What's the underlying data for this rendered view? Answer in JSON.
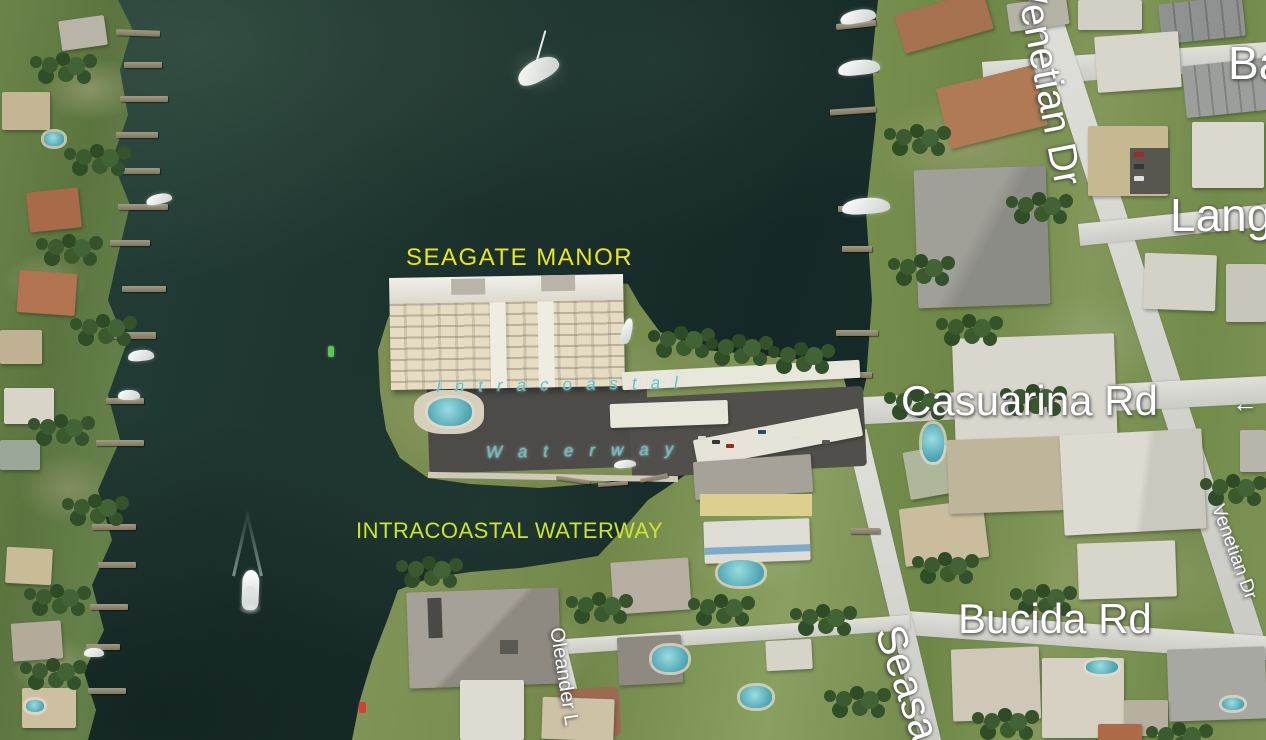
{
  "map": {
    "annotations": {
      "seagate_manor": "SEAGATE MANOR",
      "intracoastal_waterway": "INTRACOASTAL WATERWAY"
    },
    "water_text": {
      "line1": "Intracoastal",
      "line2": "Waterway"
    },
    "road_labels": {
      "venetian_top": "Venetian Dr",
      "ba_partial": "Ba",
      "lang_partial": "Lang",
      "casuarina": "Casuarina Rd",
      "direction_arrow": "←",
      "bucida": "Bucida Rd",
      "seasage_partial": "Seasa",
      "oleander_partial": "Oleander L",
      "venetian_small": "Venetian Dr"
    },
    "icons": {
      "catamaran_icon": "white anchored catamaran with mast",
      "motorboat_icon": "white motorboat cruising south with V wake",
      "channel_marker_green_icon": "green channel-marker pile",
      "buoy_red_icon": "red buoy",
      "sailboat_icon": "small white moored sailboat"
    },
    "colors": {
      "annotation_yellow": "#eae618",
      "annotation_yellow_green": "#cde32c",
      "road_label_white": "#ffffff",
      "water_text_teal": "#66bfca",
      "water_dark": "#16282a",
      "land_green": "#74894c",
      "road_surface": "#d7d7d1",
      "channel_marker_green": "#5ec453",
      "buoy_red": "#cf4433"
    }
  }
}
